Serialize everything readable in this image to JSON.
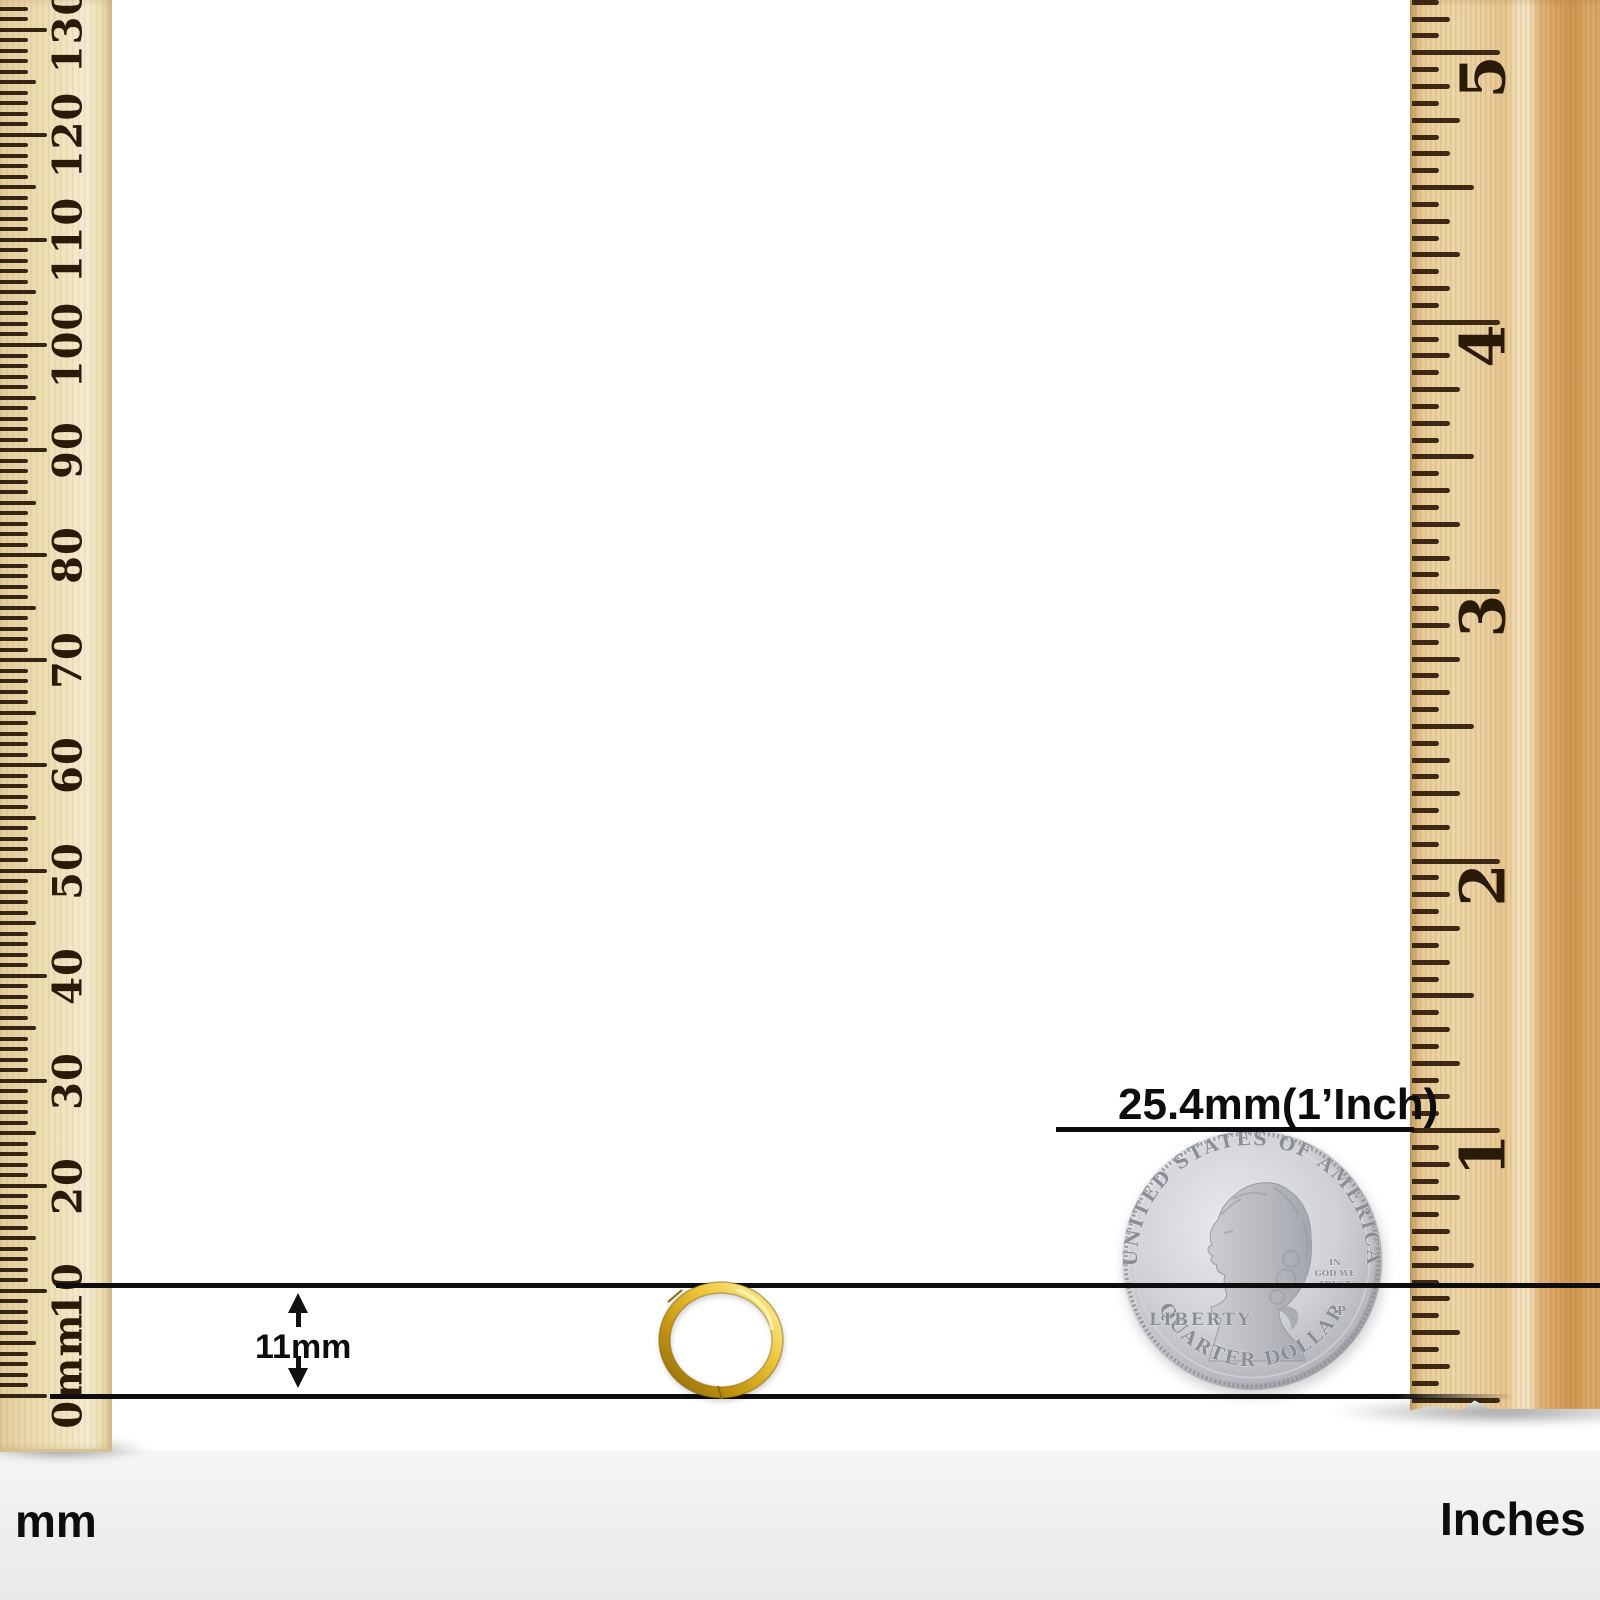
{
  "measurements": {
    "coin_size_label": "25.4mm(1’Inch)",
    "earring_size_label": "11mm"
  },
  "left_ruler": {
    "unit_label": "mm",
    "tick_labels": [
      "0mm",
      "10",
      "20",
      "30",
      "40",
      "50",
      "60",
      "70",
      "80",
      "90",
      "100",
      "110",
      "120",
      "130"
    ]
  },
  "right_ruler": {
    "unit_label": "Inches",
    "tick_labels": [
      "1",
      "2",
      "3",
      "4",
      "5"
    ]
  },
  "coin": {
    "legend_top": "UNITED STATES OF AMERICA",
    "legend_bottom": "QUARTER DOLLAR",
    "liberty": "LIBERTY",
    "motto_line1": "IN",
    "motto_line2": "GOD WE",
    "motto_line3": "TRUST",
    "mint_mark": "P"
  },
  "colors": {
    "gold": "#e0b228",
    "silver": "#c9cbcf",
    "line": "#0e0e0e",
    "wood_left": "#eddcae",
    "wood_right": "#e2b477",
    "tick": "#2a1a08"
  }
}
